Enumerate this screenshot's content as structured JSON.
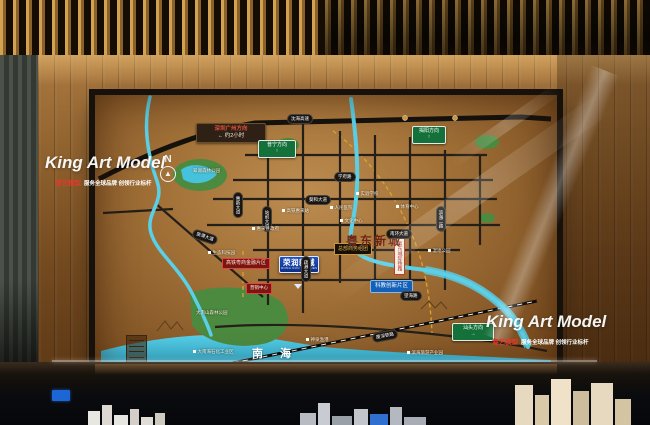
{
  "watermark": {
    "brand": "King Art Model",
    "tagline_brand": "港艺模型",
    "tagline_rest": "服务全球品牌 创领行业标杆"
  },
  "map": {
    "region_title": "粤东新城",
    "sea_label": "南 海",
    "compass": "N",
    "compass_arrow": "▲",
    "project": {
      "name": "荣润新城",
      "subtitle": "RONG RUN XIN CHENG"
    },
    "direction_signs": [
      {
        "line1": "深圳广州方向",
        "line2": "← 约2小时"
      },
      {
        "label": "普宁方向",
        "arrow": "↑"
      },
      {
        "label": "揭阳方向",
        "arrow": "↑"
      },
      {
        "label": "汕头方向",
        "arrow": "→"
      }
    ],
    "zone_signs": [
      {
        "label": "高铁粤商金融片区"
      },
      {
        "label": "营销中心"
      },
      {
        "label": "总部商务组团"
      },
      {
        "label": "科教创新片区"
      },
      {
        "label": "粤东城际铁路"
      }
    ],
    "road_pills": [
      "沈海高速",
      "葵和大道",
      "学府路",
      "南环大道",
      "望海路",
      "厦深铁路",
      "站前大道",
      "惠新大道",
      "疏港大道",
      "葵潭大道",
      "滨海二路"
    ],
    "poi_labels": [
      "高铁惠来站",
      "惠来县政府",
      "人民医院",
      "实验学校",
      "文化中心",
      "体育中心",
      "生态科技园",
      "湿地公园",
      "翠湖森林公园",
      "大南山森林公园",
      "大南海石化工业区",
      "神泉渔港",
      "滨海旅游产业园"
    ],
    "colors": {
      "board_face": "#a5743a",
      "river": "#5ad0e8",
      "park": "#4c8a3f",
      "road": "#1d1a17",
      "sign_green": "#15713a",
      "project_blue": "#1646b0",
      "accent_red": "#7c1510",
      "gold": "#c9973f"
    }
  }
}
